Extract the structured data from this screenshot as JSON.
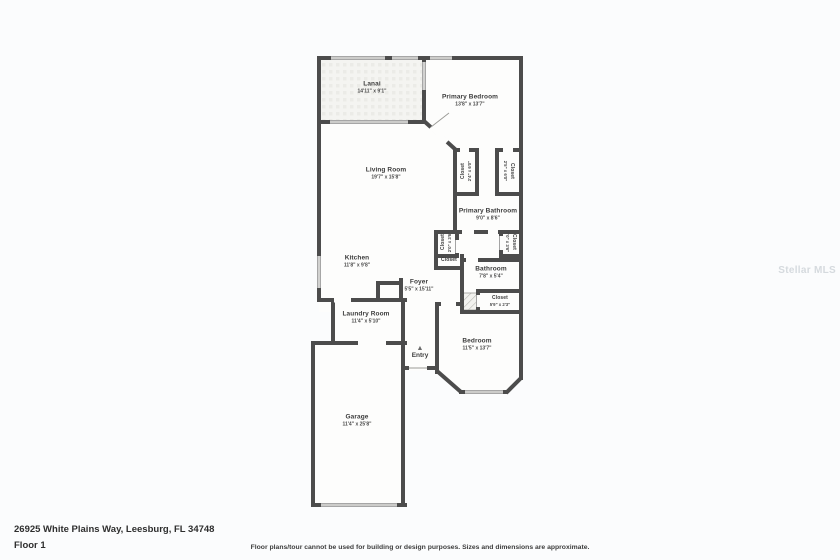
{
  "meta": {
    "address": "26925 White Plains Way, Leesburg, FL 34748",
    "floor_label": "Floor 1",
    "disclaimer": "Floor plans/tour cannot be used for building or design purposes. Sizes and dimensions are approximate.",
    "watermark": "Stellar MLS"
  },
  "colors": {
    "wall": "#4c4c4c",
    "room_fill": "#fdfdfc",
    "background": "#fbfcfd",
    "label_text": "#3b3b3b"
  },
  "rooms": [
    {
      "id": "lanai",
      "name": "Lanai",
      "dims": "14'11\" x 9'1\""
    },
    {
      "id": "primary-bedroom",
      "name": "Primary Bedroom",
      "dims": "13'8\" x 13'7\""
    },
    {
      "id": "living-room",
      "name": "Living Room",
      "dims": "19'7\" x 15'8\""
    },
    {
      "id": "closet-primary-left",
      "name": "Closet",
      "dims": "2'4\" x 6'0\""
    },
    {
      "id": "closet-primary-right",
      "name": "Closet",
      "dims": "2'5\" x 6'0\""
    },
    {
      "id": "primary-bathroom",
      "name": "Primary Bathroom",
      "dims": "9'0\" x 8'6\""
    },
    {
      "id": "closet-small-left",
      "name": "Closet",
      "dims": "2'0\" x 3'6\""
    },
    {
      "id": "closet-small-right",
      "name": "Closet",
      "dims": "2'0\" x 3'6\""
    },
    {
      "id": "closet-hall",
      "name": "Closet",
      "dims": ""
    },
    {
      "id": "kitchen",
      "name": "Kitchen",
      "dims": "11'8\" x 9'8\""
    },
    {
      "id": "foyer",
      "name": "Foyer",
      "dims": "5'5\" x 15'11\""
    },
    {
      "id": "bathroom",
      "name": "Bathroom",
      "dims": "7'8\" x 5'4\""
    },
    {
      "id": "closet-bathroom",
      "name": "Closet",
      "dims": "5'9\" x 2'3\""
    },
    {
      "id": "laundry-room",
      "name": "Laundry Room",
      "dims": "11'4\" x 5'10\""
    },
    {
      "id": "bedroom",
      "name": "Bedroom",
      "dims": "11'5\" x 13'7\""
    },
    {
      "id": "garage",
      "name": "Garage",
      "dims": "11'4\" x 25'8\""
    }
  ],
  "entry": {
    "label": "Entry",
    "arrow_icon": "▲"
  }
}
